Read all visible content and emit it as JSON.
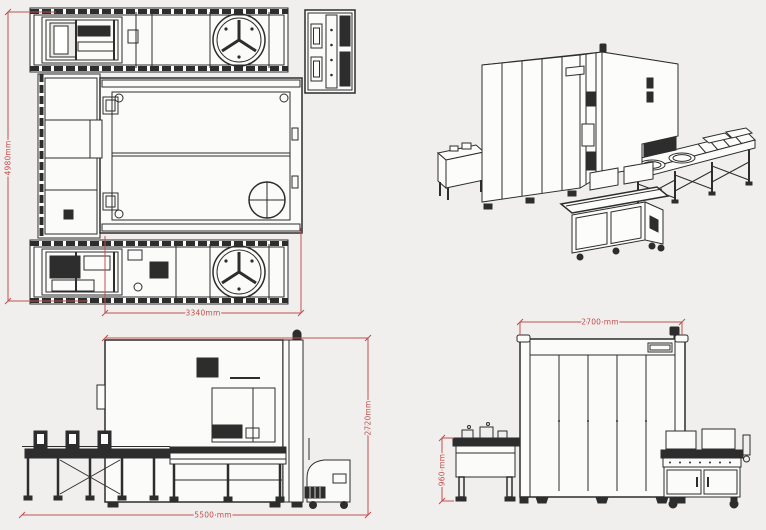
{
  "drawing": {
    "colors": {
      "background": "#f1efee",
      "linework": "#2d2d2d",
      "dimension": "#c0504d"
    },
    "views": {
      "plan": {
        "dimension_height": "4980mm",
        "dimension_width": "3340mm"
      },
      "front": {
        "dimension_width": "5500 mm",
        "dimension_height": "2720mm"
      },
      "side": {
        "dimension_width": "2700 mm",
        "dimension_height": "960 mm"
      }
    }
  }
}
